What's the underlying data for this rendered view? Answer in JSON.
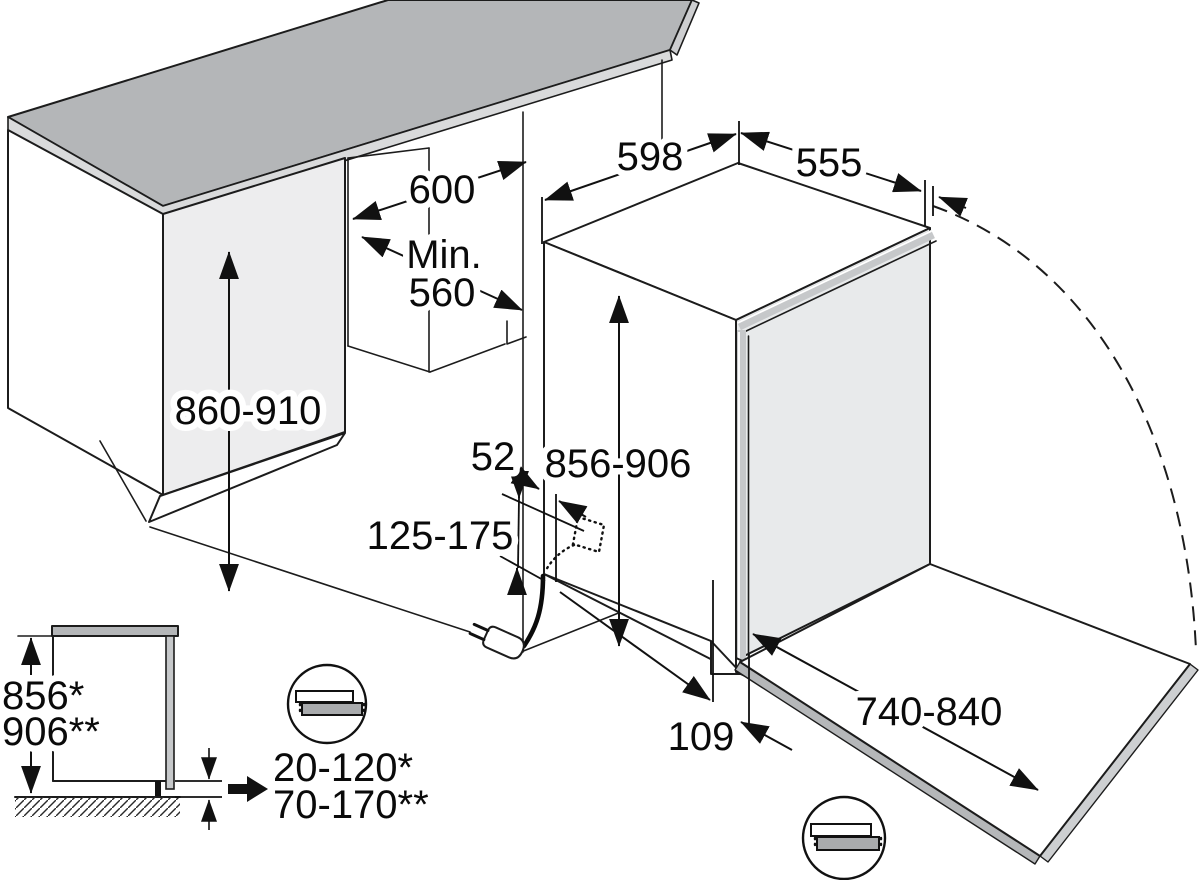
{
  "labels": {
    "top_width": "598",
    "top_depth": "555",
    "niche_width": "600",
    "niche_depth_min": "Min.",
    "niche_depth_value": "560",
    "niche_height": "860-910",
    "cord_side_offset": "52",
    "appliance_height": "856-906",
    "cord_cutout_height": "125-175",
    "plinth_depth": "109",
    "door_panel_travel": "740-840",
    "side_height_one_star": "856*",
    "side_height_two_star": "906**",
    "plinth_height_one_star": "20-120*",
    "plinth_height_two_star": "70-170**"
  },
  "colors": {
    "background": "#ffffff",
    "line": "#1c1c1c",
    "countertop_top": "#b4b6b8",
    "countertop_edge": "#d9dadb",
    "cabinet_front": "#ededee",
    "door_panel": "#e8eaeb",
    "door_edge_band": "#c6c8ca",
    "open_door_band": "#b5b7b9",
    "inset_worktop": "#b2b4b6",
    "inset_panel": "#c6c8ca",
    "callout_bar": "#a9abad"
  }
}
